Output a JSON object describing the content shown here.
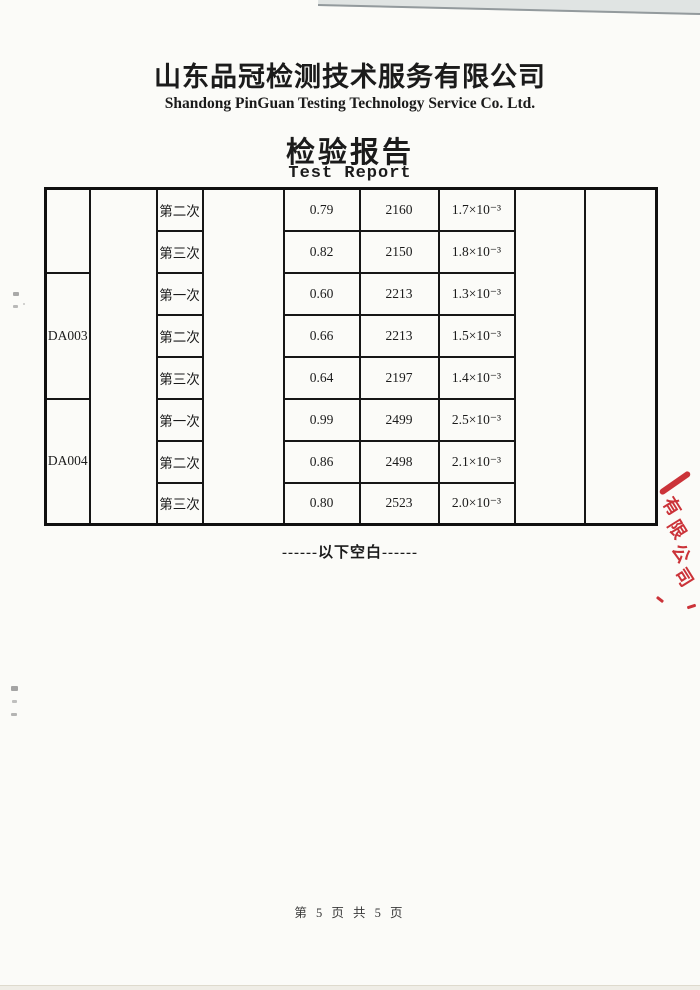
{
  "header": {
    "company_cn": "山东品冠检测技术服务有限公司",
    "company_en": "Shandong PinGuan Testing Technology Service Co. Ltd.",
    "title_cn": "检验报告",
    "title_en": "Test Report"
  },
  "table": {
    "rows": [
      {
        "sample": "",
        "trial": "第二次",
        "value": "0.79",
        "reading": "2160",
        "result": "1.7×10⁻³"
      },
      {
        "trial": "第三次",
        "value": "0.82",
        "reading": "2150",
        "result": "1.8×10⁻³"
      },
      {
        "sample": "DA003",
        "trial": "第一次",
        "value": "0.60",
        "reading": "2213",
        "result": "1.3×10⁻³"
      },
      {
        "trial": "第二次",
        "value": "0.66",
        "reading": "2213",
        "result": "1.5×10⁻³"
      },
      {
        "trial": "第三次",
        "value": "0.64",
        "reading": "2197",
        "result": "1.4×10⁻³"
      },
      {
        "sample": "DA004",
        "trial": "第一次",
        "value": "0.99",
        "reading": "2499",
        "result": "2.5×10⁻³"
      },
      {
        "trial": "第二次",
        "value": "0.86",
        "reading": "2498",
        "result": "2.1×10⁻³"
      },
      {
        "trial": "第三次",
        "value": "0.80",
        "reading": "2523",
        "result": "2.0×10⁻³"
      }
    ]
  },
  "note": {
    "text": "------以下空白------"
  },
  "stamp": {
    "chars": [
      "有",
      "限",
      "公",
      "司"
    ],
    "color": "#c8242b"
  },
  "footer": {
    "page_text": "第 5 页 共 5 页"
  },
  "colors": {
    "ink": "#1b1b1b",
    "table_border": "#161616",
    "stamp_red": "#c8242b",
    "paper": "#fbfbf8"
  }
}
